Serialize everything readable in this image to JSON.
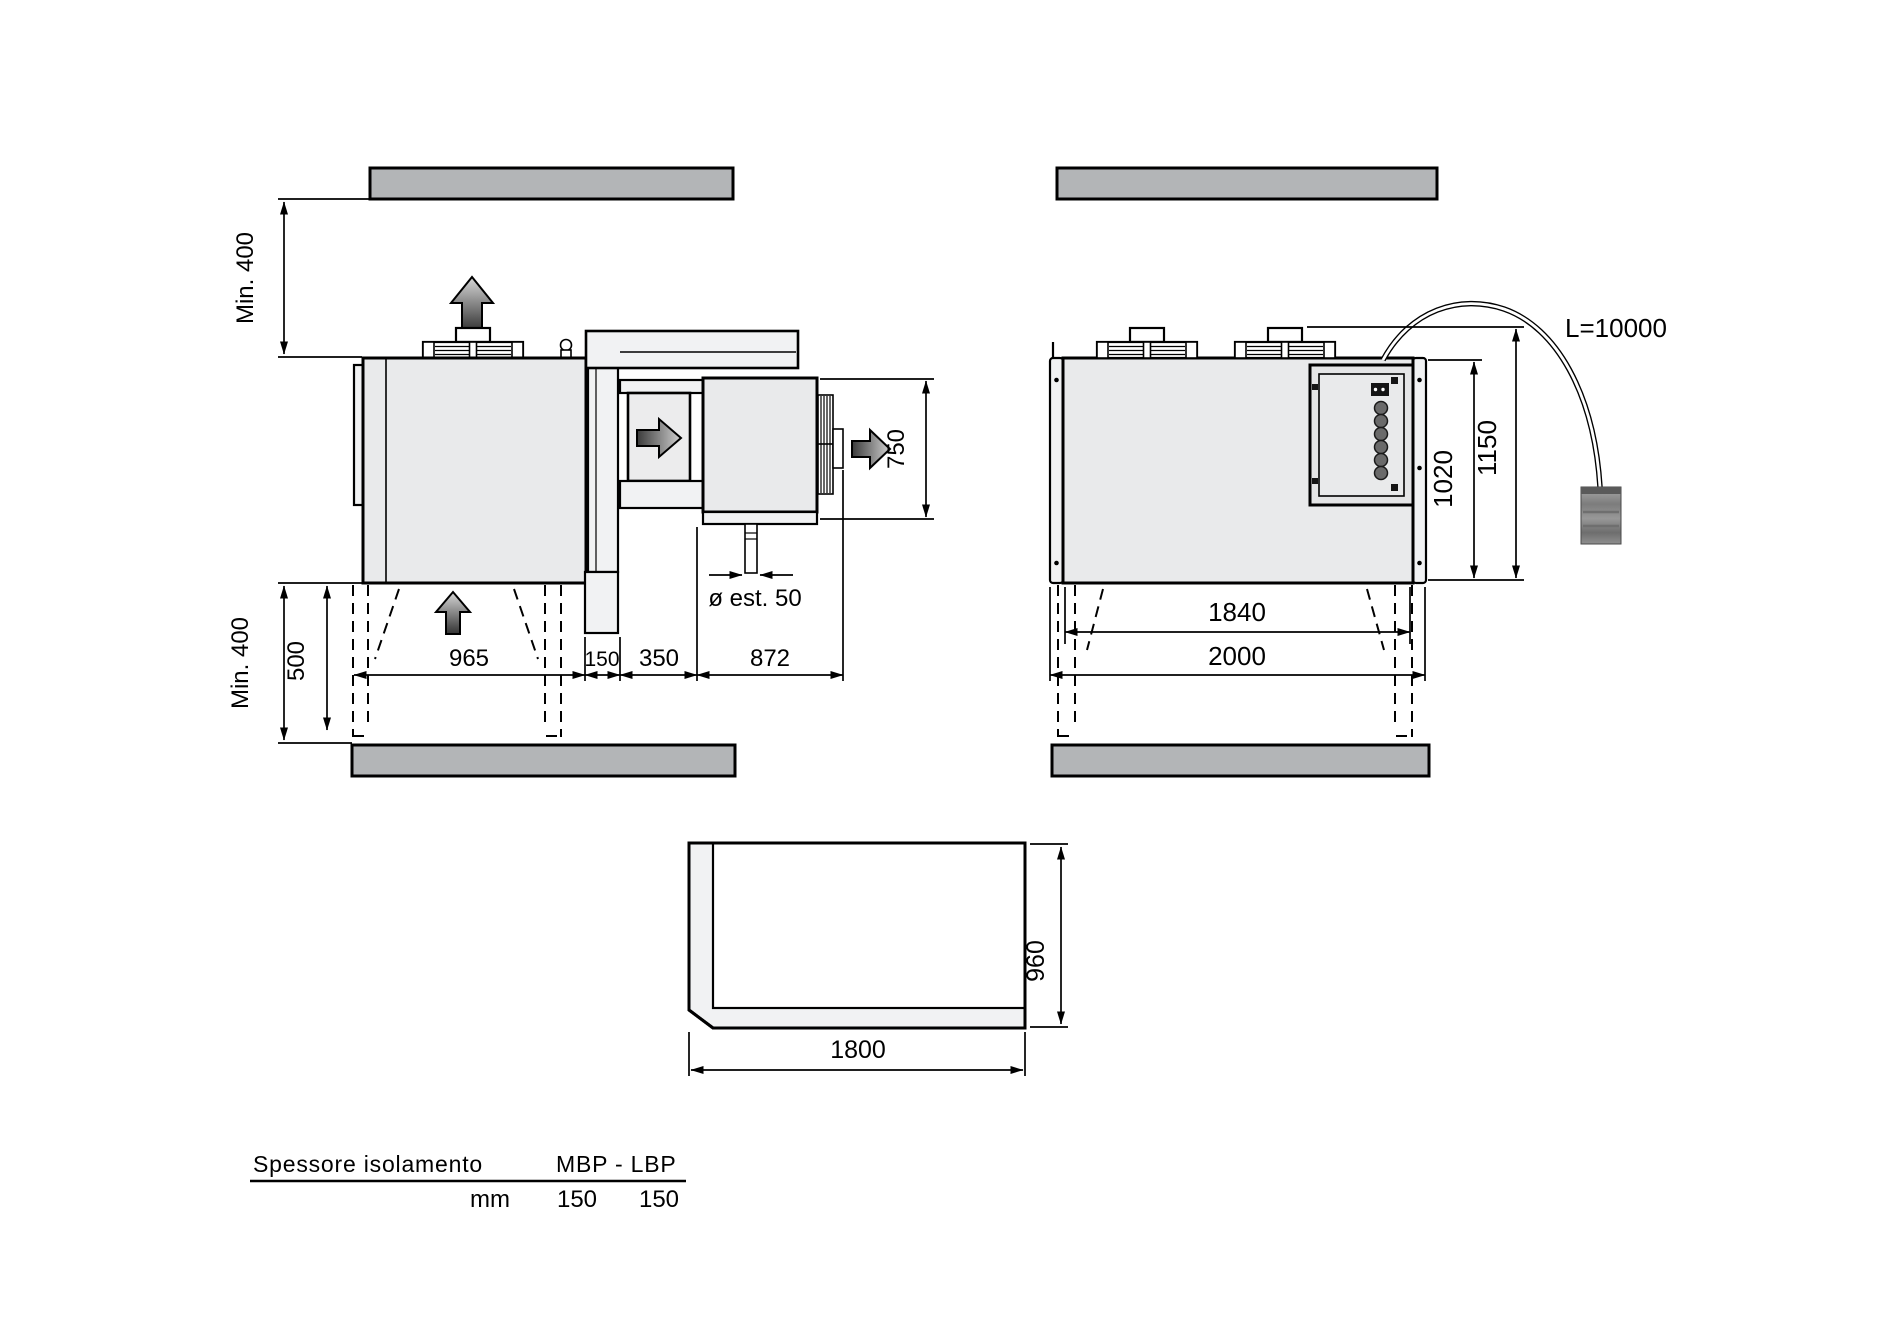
{
  "side_view": {
    "clearance_top_label": "Min. 400",
    "clearance_bottom_label": "Min. 400",
    "dim_500": "500",
    "dim_965": "965",
    "dim_150": "150",
    "dim_350": "350",
    "dim_872": "872",
    "dim_750": "750",
    "drain_diameter_label": "ø est. 50"
  },
  "front_view": {
    "cable_length_label": "L=10000",
    "dim_1020": "1020",
    "dim_1150": "1150",
    "dim_1840": "1840",
    "dim_2000": "2000"
  },
  "plan_view": {
    "dim_1800": "1800",
    "dim_960": "960"
  },
  "insulation_table": {
    "header_left": "Spessore isolamento",
    "header_right": "MBP - LBP",
    "unit_label": "mm",
    "mbp_value": "150",
    "lbp_value": "150"
  },
  "icons": {
    "airflow_up": "up-arrow",
    "airflow_right": "right-arrow"
  },
  "colors": {
    "line": "#000000",
    "slab_fill": "#b3b5b7",
    "unit_fill": "#e9eaeb",
    "panel_fill": "#f1f2f3",
    "background": "#ffffff"
  }
}
